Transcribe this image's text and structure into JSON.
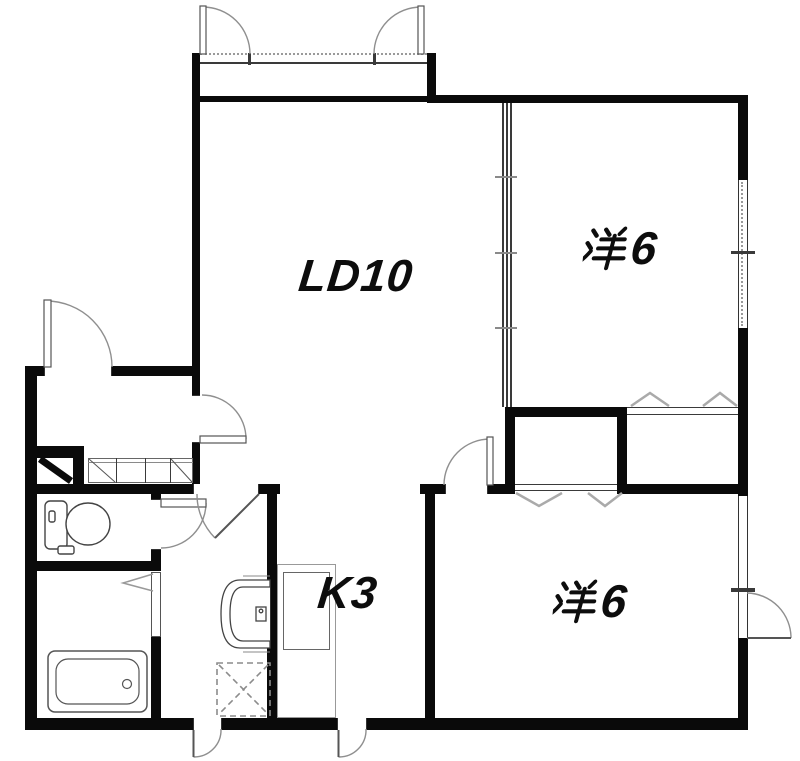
{
  "document": {
    "type": "apartment-floor-plan"
  },
  "rooms": [
    {
      "key": "living-dining",
      "label": "LD10"
    },
    {
      "key": "western-room-north",
      "label": "洋6",
      "kanji": "洋",
      "size": "6"
    },
    {
      "key": "western-room-south",
      "label": "洋6",
      "kanji": "洋",
      "size": "6"
    },
    {
      "key": "kitchen",
      "label": "K3"
    }
  ],
  "elements": {
    "doors": [
      "entrance-door",
      "balcony-door-left",
      "balcony-door-right",
      "living-room-door",
      "toilet-door",
      "washroom-door",
      "bathroom-folding-door",
      "bedroom-south-door",
      "utility-back-door",
      "kitchen-back-door",
      "bedroom-south-exterior-door"
    ],
    "windows": [
      "bedroom-north-window",
      "bedroom-south-window"
    ],
    "closets": [
      "closet-bedroom-south",
      "closet-bedroom-north"
    ],
    "fixtures": [
      "toilet",
      "washbasin",
      "bathtub",
      "washing-machine-pan",
      "kitchen-counter",
      "shoe-cabinet"
    ]
  },
  "colors": {
    "wall": "#0a0a0a",
    "line": "#444444",
    "door_arc": "#999999",
    "label": "#111111",
    "background": "#ffffff"
  }
}
